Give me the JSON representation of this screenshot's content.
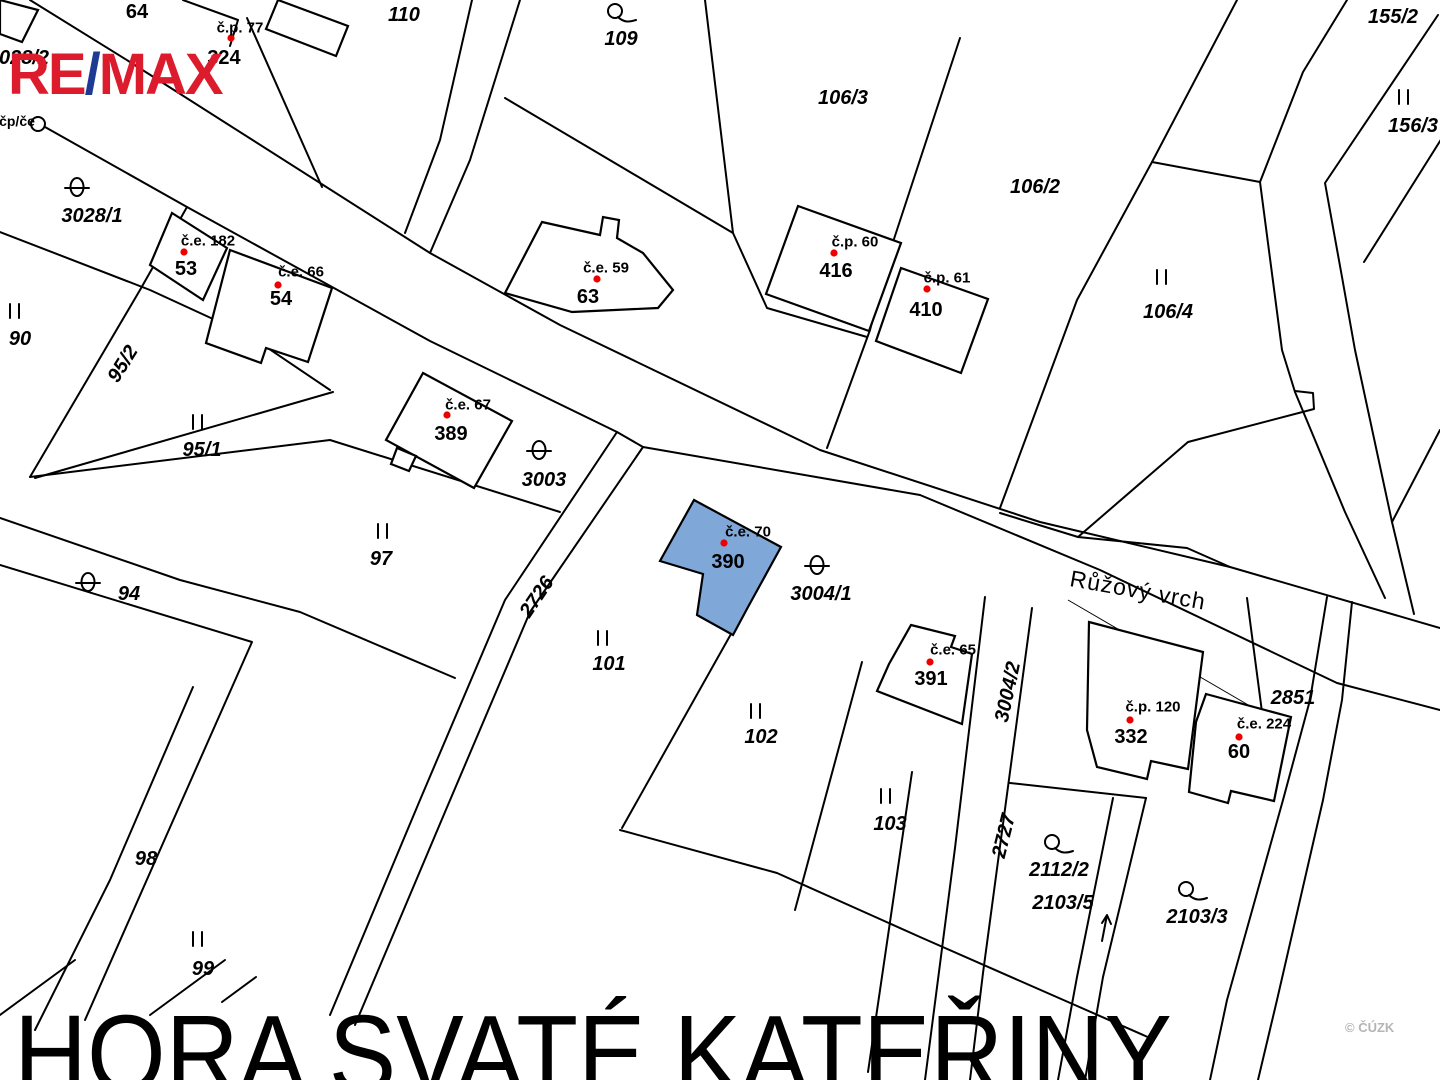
{
  "branding": {
    "logo_re": "RE",
    "logo_slash": "/",
    "logo_max": "MAX"
  },
  "title_overlay": {
    "text": "HORA SVATÉ KATEŘINY"
  },
  "watermark": {
    "text": "© ČÚZK"
  },
  "colors": {
    "highlight_fill": "#7FA8D9",
    "red_label": "#EE0000",
    "line": "#000000",
    "watermark_gray": "#B5B5B5",
    "logo_red": "#DC1B2C",
    "logo_blue": "#1F3A93"
  },
  "map": {
    "labels": [
      {
        "text": "64",
        "x": 137,
        "y": 12,
        "kind": "bldg"
      },
      {
        "text": "č.p. 77",
        "x": 240,
        "y": 28,
        "kind": "red"
      },
      {
        "text": "324",
        "x": 224,
        "y": 58,
        "kind": "bldg"
      },
      {
        "text": "110",
        "x": 404,
        "y": 15,
        "kind": "land"
      },
      {
        "text": "109",
        "x": 621,
        "y": 39,
        "kind": "land"
      },
      {
        "text": "106/3",
        "x": 843,
        "y": 98,
        "kind": "land"
      },
      {
        "text": "155/2",
        "x": 1393,
        "y": 17,
        "kind": "land"
      },
      {
        "text": "156/3",
        "x": 1413,
        "y": 126,
        "kind": "land"
      },
      {
        "text": "028/2",
        "x": 24,
        "y": 58,
        "kind": "land"
      },
      {
        "text": "čp/če",
        "x": 17,
        "y": 121,
        "kind": "smallred"
      },
      {
        "text": "3028/1",
        "x": 92,
        "y": 216,
        "kind": "land"
      },
      {
        "text": "č.e. 182",
        "x": 208,
        "y": 241,
        "kind": "red"
      },
      {
        "text": "53",
        "x": 186,
        "y": 269,
        "kind": "bldg"
      },
      {
        "text": "č.e. 66",
        "x": 301,
        "y": 272,
        "kind": "red"
      },
      {
        "text": "54",
        "x": 281,
        "y": 299,
        "kind": "bldg"
      },
      {
        "text": "č.e. 59",
        "x": 606,
        "y": 268,
        "kind": "red"
      },
      {
        "text": "63",
        "x": 588,
        "y": 297,
        "kind": "bldg"
      },
      {
        "text": "č.p. 60",
        "x": 855,
        "y": 242,
        "kind": "red"
      },
      {
        "text": "416",
        "x": 836,
        "y": 271,
        "kind": "bldg"
      },
      {
        "text": "č.p. 61",
        "x": 947,
        "y": 278,
        "kind": "red"
      },
      {
        "text": "410",
        "x": 926,
        "y": 310,
        "kind": "bldg"
      },
      {
        "text": "106/2",
        "x": 1035,
        "y": 187,
        "kind": "land"
      },
      {
        "text": "106/4",
        "x": 1168,
        "y": 312,
        "kind": "land"
      },
      {
        "text": "90",
        "x": 20,
        "y": 339,
        "kind": "land"
      },
      {
        "text": "95/2",
        "x": 123,
        "y": 364,
        "kind": "land",
        "rot": -58
      },
      {
        "text": "95/1",
        "x": 202,
        "y": 450,
        "kind": "land"
      },
      {
        "text": "č.e. 67",
        "x": 468,
        "y": 405,
        "kind": "red"
      },
      {
        "text": "389",
        "x": 451,
        "y": 434,
        "kind": "bldg"
      },
      {
        "text": "3003",
        "x": 544,
        "y": 480,
        "kind": "land"
      },
      {
        "text": "97",
        "x": 381,
        "y": 559,
        "kind": "land"
      },
      {
        "text": "94",
        "x": 129,
        "y": 594,
        "kind": "land"
      },
      {
        "text": "2726",
        "x": 537,
        "y": 597,
        "kind": "land",
        "rot": -56
      },
      {
        "text": "č.e. 70",
        "x": 748,
        "y": 532,
        "kind": "red"
      },
      {
        "text": "390",
        "x": 728,
        "y": 562,
        "kind": "bldg"
      },
      {
        "text": "3004/1",
        "x": 821,
        "y": 594,
        "kind": "land"
      },
      {
        "text": "Růžový vrch",
        "x": 1138,
        "y": 590,
        "kind": "street",
        "rot": 10
      },
      {
        "text": "č.e. 65",
        "x": 953,
        "y": 650,
        "kind": "red"
      },
      {
        "text": "391",
        "x": 931,
        "y": 679,
        "kind": "bldg"
      },
      {
        "text": "3004/2",
        "x": 1008,
        "y": 692,
        "kind": "land",
        "rot": -78
      },
      {
        "text": "101",
        "x": 609,
        "y": 664,
        "kind": "land"
      },
      {
        "text": "102",
        "x": 761,
        "y": 737,
        "kind": "land"
      },
      {
        "text": "2851",
        "x": 1293,
        "y": 698,
        "kind": "land"
      },
      {
        "text": "č.p. 120",
        "x": 1153,
        "y": 707,
        "kind": "red"
      },
      {
        "text": "332",
        "x": 1131,
        "y": 737,
        "kind": "bldg"
      },
      {
        "text": "č.e. 224",
        "x": 1264,
        "y": 724,
        "kind": "red"
      },
      {
        "text": "60",
        "x": 1239,
        "y": 752,
        "kind": "bldg"
      },
      {
        "text": "103",
        "x": 890,
        "y": 824,
        "kind": "land"
      },
      {
        "text": "2727",
        "x": 1004,
        "y": 836,
        "kind": "land",
        "rot": -76
      },
      {
        "text": "98",
        "x": 146,
        "y": 859,
        "kind": "land"
      },
      {
        "text": "99",
        "x": 203,
        "y": 969,
        "kind": "land"
      },
      {
        "text": "2112/2",
        "x": 1059,
        "y": 870,
        "kind": "land"
      },
      {
        "text": "2103/5",
        "x": 1063,
        "y": 903,
        "kind": "land"
      },
      {
        "text": "2103/3",
        "x": 1197,
        "y": 917,
        "kind": "land"
      }
    ],
    "symbols": [
      {
        "type": "circle-flag",
        "x": 615,
        "y": 11
      },
      {
        "type": "meadow",
        "x": 1404,
        "y": 98
      },
      {
        "type": "circle",
        "x": 38,
        "y": 124
      },
      {
        "type": "theta",
        "x": 77,
        "y": 187
      },
      {
        "type": "red-dot",
        "x": 231,
        "y": 38
      },
      {
        "type": "red-dot",
        "x": 184,
        "y": 252
      },
      {
        "type": "red-dot",
        "x": 278,
        "y": 285
      },
      {
        "type": "red-dot",
        "x": 597,
        "y": 279
      },
      {
        "type": "red-dot",
        "x": 834,
        "y": 253
      },
      {
        "type": "red-dot",
        "x": 927,
        "y": 289
      },
      {
        "type": "meadow",
        "x": 1162,
        "y": 278
      },
      {
        "type": "meadow",
        "x": 15,
        "y": 312
      },
      {
        "type": "meadow",
        "x": 198,
        "y": 423
      },
      {
        "type": "red-dot",
        "x": 447,
        "y": 415
      },
      {
        "type": "theta",
        "x": 539,
        "y": 450
      },
      {
        "type": "meadow",
        "x": 383,
        "y": 532
      },
      {
        "type": "theta",
        "x": 88,
        "y": 582
      },
      {
        "type": "red-dot",
        "x": 724,
        "y": 543
      },
      {
        "type": "theta",
        "x": 817,
        "y": 565
      },
      {
        "type": "red-dot",
        "x": 930,
        "y": 662
      },
      {
        "type": "meadow",
        "x": 603,
        "y": 639
      },
      {
        "type": "meadow",
        "x": 756,
        "y": 712
      },
      {
        "type": "red-dot",
        "x": 1130,
        "y": 720
      },
      {
        "type": "red-dot",
        "x": 1239,
        "y": 737
      },
      {
        "type": "meadow",
        "x": 886,
        "y": 797
      },
      {
        "type": "meadow",
        "x": 198,
        "y": 940
      },
      {
        "type": "circle-flag",
        "x": 1052,
        "y": 842
      },
      {
        "type": "circle-flag",
        "x": 1186,
        "y": 889
      },
      {
        "type": "slope-arrow",
        "x": 1101,
        "y": 925
      }
    ],
    "highlighted_parcel": {
      "number": "390",
      "note_label": "č.e. 70"
    }
  }
}
